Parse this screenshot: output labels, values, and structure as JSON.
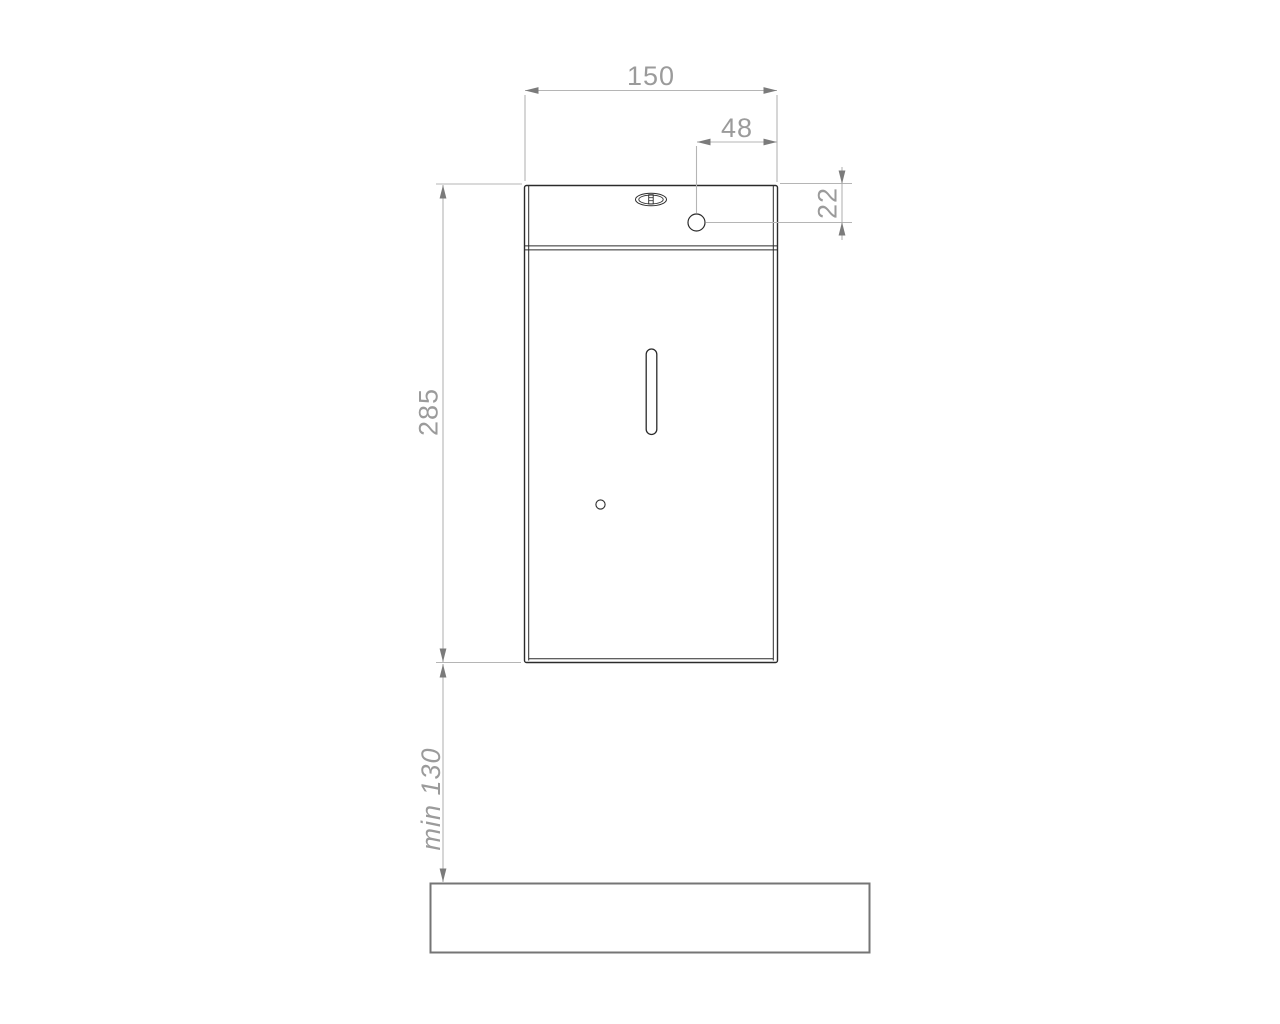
{
  "drawing": {
    "kind": "dispenser-front-elevation-with-mounting-dimensions",
    "labels": {
      "width": "150",
      "hole_offset": "48",
      "hole_drop": "22",
      "height": "285",
      "clearance": "min 130"
    },
    "colors": {
      "background": "#ffffff",
      "object_line": "#2b2b2b",
      "surface_line": "#757575",
      "dimension_line": "#b5b5b5",
      "arrow": "#7b7b7b",
      "label_text": "#9b9b9b"
    }
  }
}
